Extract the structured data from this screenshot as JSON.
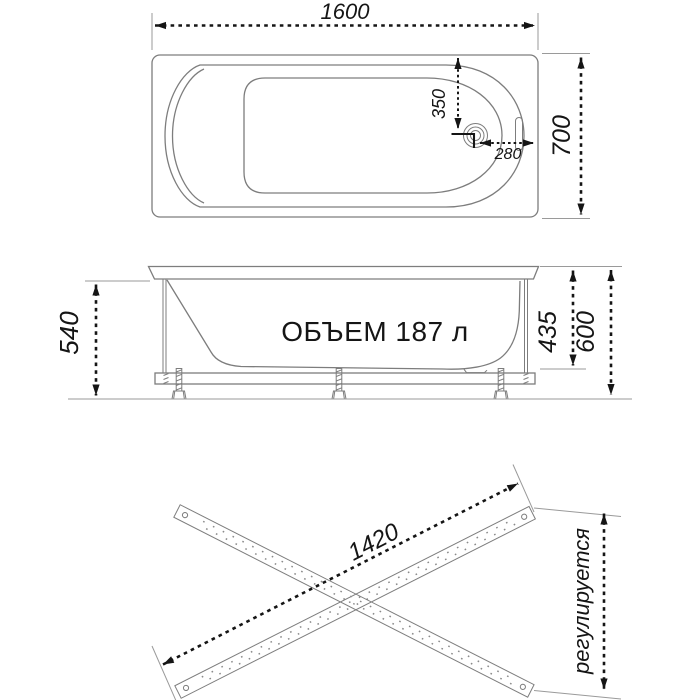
{
  "colors": {
    "background": "#ffffff",
    "drawing_line": "#7d7d7d",
    "dimension": "#151515",
    "extension_line": "#9a9a9a"
  },
  "top_view": {
    "dim_length": "1600",
    "dim_width": "700",
    "dim_drain_from_edge": "350",
    "dim_drain_from_end": "280"
  },
  "side_view": {
    "volume_label": "ОБЪЕМ 187 л",
    "dim_apron_height": "540",
    "dim_inner_depth": "435",
    "dim_total_height": "600"
  },
  "bottom_view": {
    "dim_rail_length": "1420",
    "adjustable_label": "регулируется"
  }
}
